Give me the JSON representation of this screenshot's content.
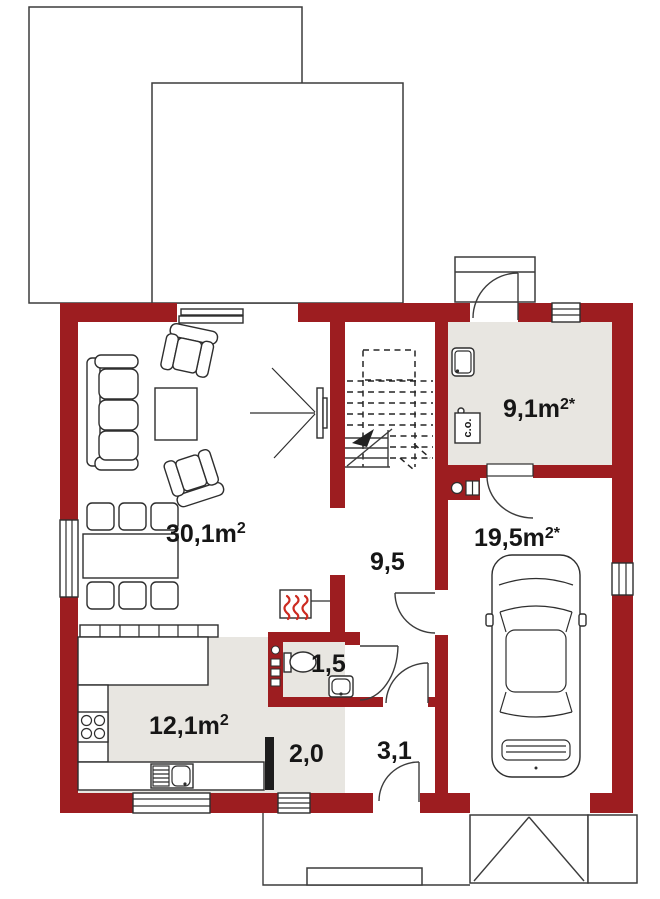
{
  "colors": {
    "wall": "#9d1d20",
    "floor": "#e8e6e1",
    "line": "#3c3c3c",
    "flame": "#cc2a20"
  },
  "rooms": {
    "living": {
      "base": "30,1m",
      "sup": "2"
    },
    "hall": {
      "base": "9,5",
      "sup": ""
    },
    "wc": {
      "base": "1,5",
      "sup": ""
    },
    "kitchen": {
      "base": "12,1m",
      "sup": "2"
    },
    "corridor": {
      "base": "2,0",
      "sup": ""
    },
    "vestibule": {
      "base": "3,1",
      "sup": ""
    },
    "utility": {
      "base": "9,1m",
      "sup": "2*"
    },
    "garage": {
      "base": "19,5m",
      "sup": "2*"
    },
    "boiler": {
      "label": "c.o."
    }
  }
}
